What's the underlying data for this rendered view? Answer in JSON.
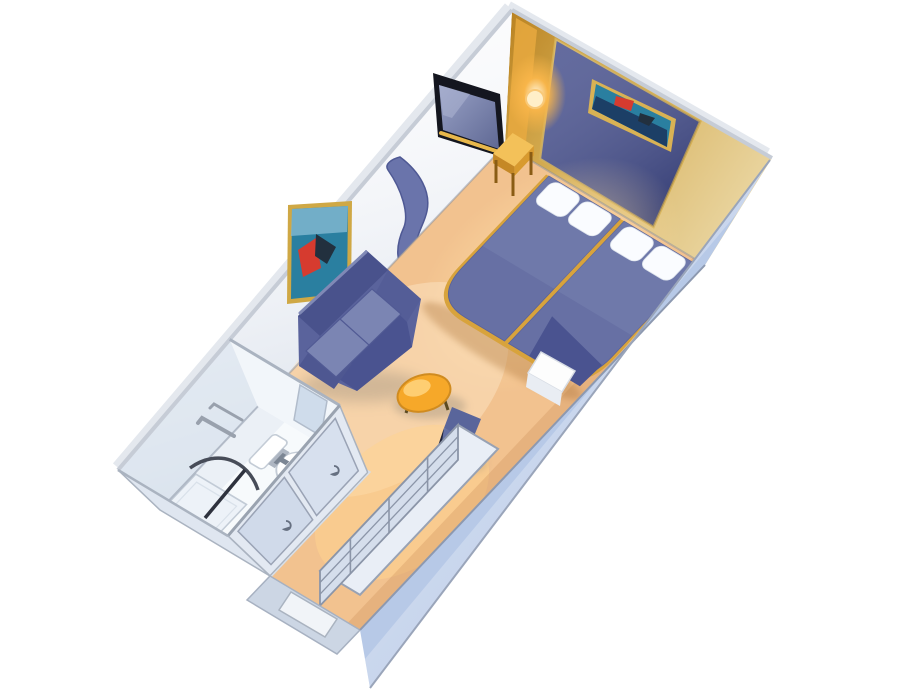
{
  "scene": {
    "description": "3D isometric cutaway floor plan of a cruise-ship interior stateroom",
    "view": "axonometric dollhouse view, no visible text",
    "background": "#ffffff"
  },
  "palette": {
    "background": "#ffffff",
    "carpet": "#f2c28f",
    "carpet_glow": "#ffe2a9",
    "wall_white": "#fdfdfe",
    "wall_shade": "#dce6f0",
    "wall_top_edge": "#c6ccd6",
    "accent_wall": "#4a538f",
    "accent_border": "#d4af54",
    "gold": "#d8a33c",
    "gold_bright": "#f3c159",
    "gold_dark": "#b8801f",
    "lamp_glow": "#f9b64a",
    "tv_frame": "#14161f",
    "tv_screen": "#7e87b0",
    "art_teal": "#2a7fa0",
    "art_navy": "#1c3f66",
    "art_red": "#d63b2f",
    "art_dark": "#22303e",
    "bedspread": "#6770a4",
    "bedspread_dark": "#4a5390",
    "pillow": "#fafcff",
    "sofa": "#5a639c",
    "sofa_dark": "#49528c",
    "sofa_light": "#7b85b3",
    "curtain": "#6a74ab",
    "table_orange": "#f6a829",
    "table_light": "#ffd27a",
    "chair_blue": "#6571a5",
    "bathroom_floor": "#f7fafc",
    "fixture_white": "#ffffff",
    "fixture_outline": "#c4ccd6",
    "metal_dark": "#474c58",
    "towel_bar": "#99a1ad",
    "mirror_panel": "#d7e0ee",
    "mirror_stroke": "#9aa3b5",
    "exterior_wall": "#b7c9e7",
    "entry_band": "#ccd6e4",
    "door_white": "#f1f4f8",
    "shelf_face": "#d5deec",
    "shelf_top": "#e9eef6",
    "shelf_line": "#8b95a8",
    "shadow": "#8c8376"
  },
  "objects": [
    {
      "id": "accent-headboard-wall",
      "label": "navy accent wall with gold trim"
    },
    {
      "id": "headboard-artwork",
      "label": "framed underwater artwork above beds"
    },
    {
      "id": "wall-sconce",
      "label": "glowing amber wall sconce"
    },
    {
      "id": "twin-bed-left",
      "label": "twin bed with blue bedspread"
    },
    {
      "id": "twin-bed-right",
      "label": "twin bed with blue bedspread"
    },
    {
      "id": "pillows",
      "label": "white pillows"
    },
    {
      "id": "nightstand",
      "label": "gold bedside table"
    },
    {
      "id": "tv-niche",
      "label": "recessed wall television"
    },
    {
      "id": "sofa-artwork",
      "label": "framed diver artwork above sofa"
    },
    {
      "id": "privacy-curtain",
      "label": "blue room-divider curtain"
    },
    {
      "id": "loveseat",
      "label": "blue two-seat sofa"
    },
    {
      "id": "coffee-table",
      "label": "round orange coffee table"
    },
    {
      "id": "desk-chair",
      "label": "blue desk chair"
    },
    {
      "id": "mini-cabinet",
      "label": "small white cabinet"
    },
    {
      "id": "vanity-shelf-unit",
      "label": "desk and shelving unit along cabin wall"
    },
    {
      "id": "closet-doors",
      "label": "mirrored sliding closet doors"
    },
    {
      "id": "bathroom",
      "label": "en-suite bathroom"
    },
    {
      "id": "toilet",
      "label": "toilet"
    },
    {
      "id": "sink-vanity",
      "label": "sink vanity"
    },
    {
      "id": "shower",
      "label": "corner shower with curved rail"
    },
    {
      "id": "towel-bars",
      "label": "towel bars"
    },
    {
      "id": "entry-door",
      "label": "cabin entry door"
    },
    {
      "id": "exterior-hull-wall",
      "label": "periwinkle exterior wall band"
    }
  ]
}
